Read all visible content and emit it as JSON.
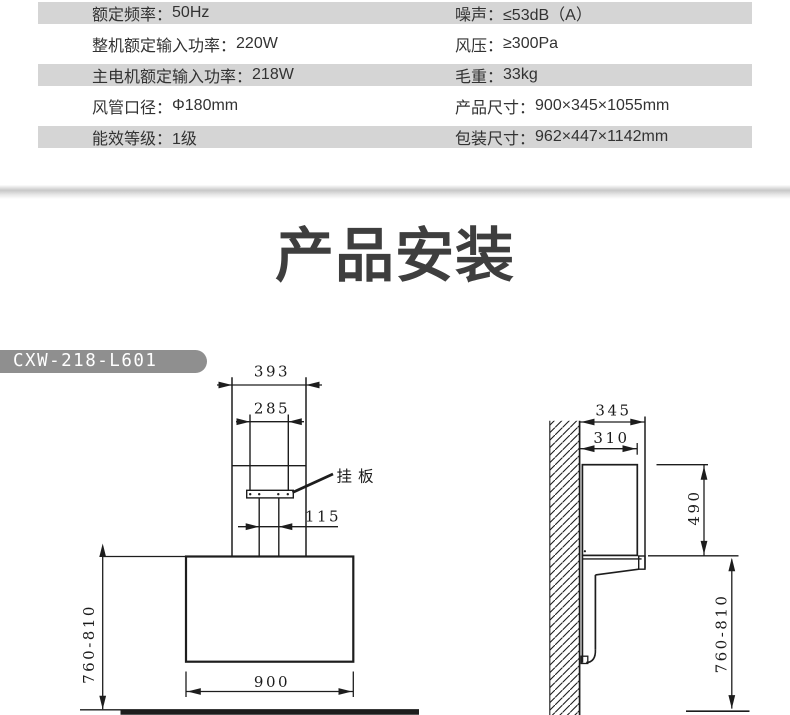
{
  "spec_table": {
    "shade_color": "#d5d5d5",
    "text_color": "#323232",
    "rows": [
      {
        "col1_label": "额定频率：",
        "col1_value": "50Hz",
        "col2_label": "噪声：",
        "col2_value": "≤53dB（A）"
      },
      {
        "col1_label": "整机额定输入功率：",
        "col1_value": "220W",
        "col2_label": "风压：",
        "col2_value": "≥300Pa"
      },
      {
        "col1_label": "主电机额定输入功率：",
        "col1_value": "218W",
        "col2_label": "毛重：",
        "col2_value": "33kg"
      },
      {
        "col1_label": "风管口径：",
        "col1_value": "Φ180mm",
        "col2_label": "产品尺寸：",
        "col2_value": "900×345×1055mm"
      },
      {
        "col1_label": "能效等级：",
        "col1_value": "1级",
        "col2_label": "包装尺寸：",
        "col2_value": "962×447×1142mm"
      }
    ]
  },
  "section": {
    "title": "产品安装",
    "title_color": "#3e3e3e"
  },
  "model_badge": {
    "text": "CXW-218-L601",
    "bg_color": "#8f8f8f"
  },
  "installation_diagram": {
    "line_color": "#1d1d1d",
    "front_view": {
      "dim_overall_width": "393",
      "dim_duct_width": "285",
      "plate_label": "挂板",
      "dim_plate_offset": "115",
      "dim_body_width": "900",
      "dim_install_height": "760-810"
    },
    "side_view": {
      "dim_overall_depth": "345",
      "dim_duct_depth": "310",
      "dim_chimney_height": "490",
      "dim_install_height": "760-810"
    }
  }
}
